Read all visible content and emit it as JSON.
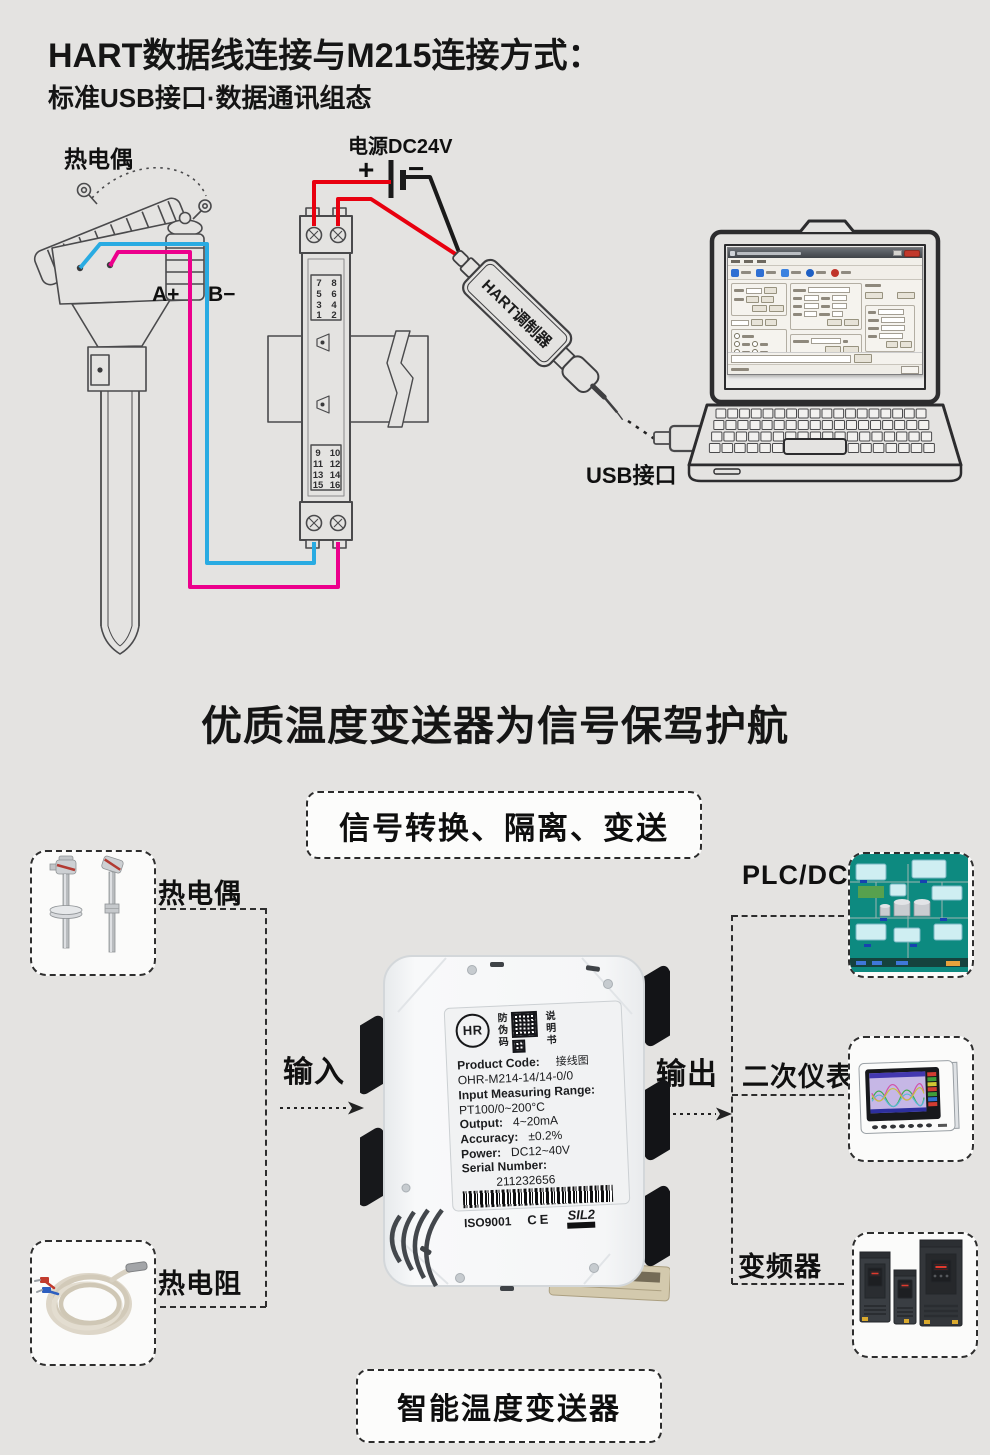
{
  "colors": {
    "bg": "#e4e3e1",
    "line_gray": "#4a4a4c",
    "wire_red": "#e8000f",
    "wire_blue": "#29abe2",
    "wire_magenta": "#ec008c",
    "wire_black": "#1a1a1a",
    "scada_teal": "#0d8a80"
  },
  "header": {
    "title": "HART数据线连接与M215连接方式：",
    "subtitle": "标准USB接口·数据通讯组态"
  },
  "diagram": {
    "thermocouple_label": "热电偶",
    "a_plus": "A+",
    "b_minus": "B−",
    "power_label": "电源DC24V",
    "plus": "+",
    "minus": "−",
    "modulator_label": "HART调制器",
    "usb_label": "USB接口",
    "module": {
      "top": [
        [
          "7",
          "8"
        ],
        [
          "5",
          "6"
        ],
        [
          "3",
          "4"
        ],
        [
          "1",
          "2"
        ]
      ],
      "bottom": [
        [
          "9",
          "10"
        ],
        [
          "11",
          "12"
        ],
        [
          "13",
          "14"
        ],
        [
          "15",
          "16"
        ]
      ]
    }
  },
  "slogan": "优质温度变送器为信号保驾护航",
  "banner": "信号转换、隔离、变送",
  "flow": {
    "input_label": "输入",
    "output_label": "输出",
    "sources": [
      "热电偶",
      "热电阻"
    ],
    "destinations": [
      "PLC/DCS",
      "二次仪表",
      "变频器"
    ]
  },
  "product": {
    "logo_text": "HR",
    "antifake": "防伪码",
    "manual": "说明书",
    "wiring_label": "接线图",
    "code_label": "Product Code:",
    "code": "OHR-M214-14/14-0/0",
    "range_label": "Input Measuring Range:",
    "range": "PT100/0~200°C",
    "output_label": "Output:",
    "output": "4~20mA",
    "accuracy_label": "Accuracy:",
    "accuracy": "±0.2%",
    "power_label": "Power:",
    "power": "DC12~40V",
    "serial_label": "Serial Number:",
    "serial": "211232656",
    "cert_iso": "ISO9001",
    "cert_ce": "CE",
    "cert_sil": "SIL2"
  },
  "footer_banner": "智能温度变送器"
}
